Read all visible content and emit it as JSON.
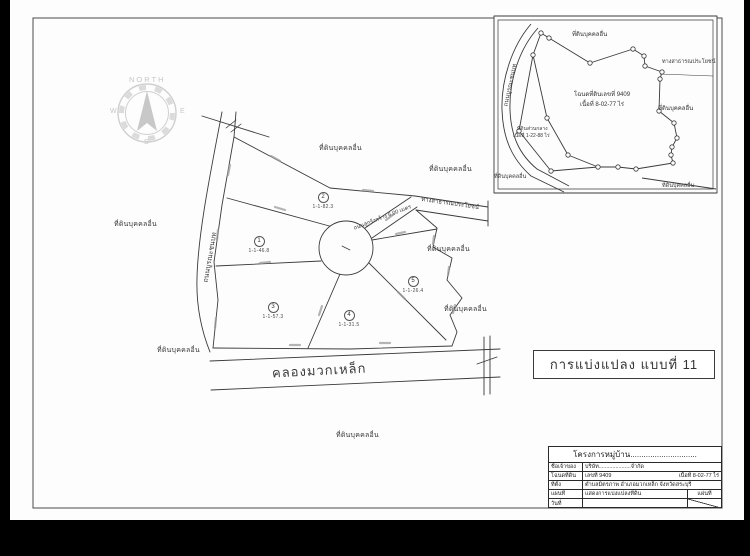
{
  "compass": {
    "north": "NORTH",
    "west": "W",
    "east": "E",
    "south": "S"
  },
  "labels": {
    "other_land": "ที่ดินบุคคลอื่น"
  },
  "main_map": {
    "left_road": "ถนนบูรณะชนบท",
    "access_road": "ถนนลูกรังกว้าง 6.00 เมตร",
    "public_road": "ทางสาธารณประโยชน์",
    "canal": "คลองมวกเหล็ก",
    "plots": [
      {
        "no": "1",
        "area": "1-1-46.8"
      },
      {
        "no": "2",
        "area": "1-1-82.3"
      },
      {
        "no": "3",
        "area": "1-1-57.3"
      },
      {
        "no": "4",
        "area": "1-1-31.5"
      },
      {
        "no": "5",
        "area": "1-1-26.4"
      }
    ]
  },
  "inset": {
    "public_road": "ทางสาธารณประโยชน์",
    "road_left": "ถนนบูรณะชนบท",
    "deed_line1": "โฉนดที่ดินเลขที่ 9409",
    "deed_line2": "เนื้อที่ 8-02-77 ไร่",
    "common_line1": "ที่ดินส่วนกลาง",
    "common_line2": "เนื้อที่ 1-22-88 ไร่"
  },
  "plan_box": {
    "title": "การแบ่งแปลง แบบที่ 11"
  },
  "title_block": {
    "header": "โครงการหมู่บ้าน..............................",
    "rows": [
      {
        "label": "ชื่อเจ้าของ",
        "value": "บริษัท.....................จำกัด",
        "value2": ""
      },
      {
        "label": "โฉนดที่ดิน",
        "value": "เลขที่ 9409",
        "value2": "เนื้อที่ 8-02-77 ไร่"
      },
      {
        "label": "ที่ตั้ง",
        "value": "ตำบลมิตรภาพ  อำเภอมวกเหล็ก  จังหวัดสระบุรี",
        "value2": ""
      },
      {
        "label": "แผนที่",
        "value": "แสดงการแบ่งแปลงที่ดิน",
        "extra": "แผ่นที่"
      },
      {
        "label": "วันที่",
        "value": ""
      }
    ]
  }
}
